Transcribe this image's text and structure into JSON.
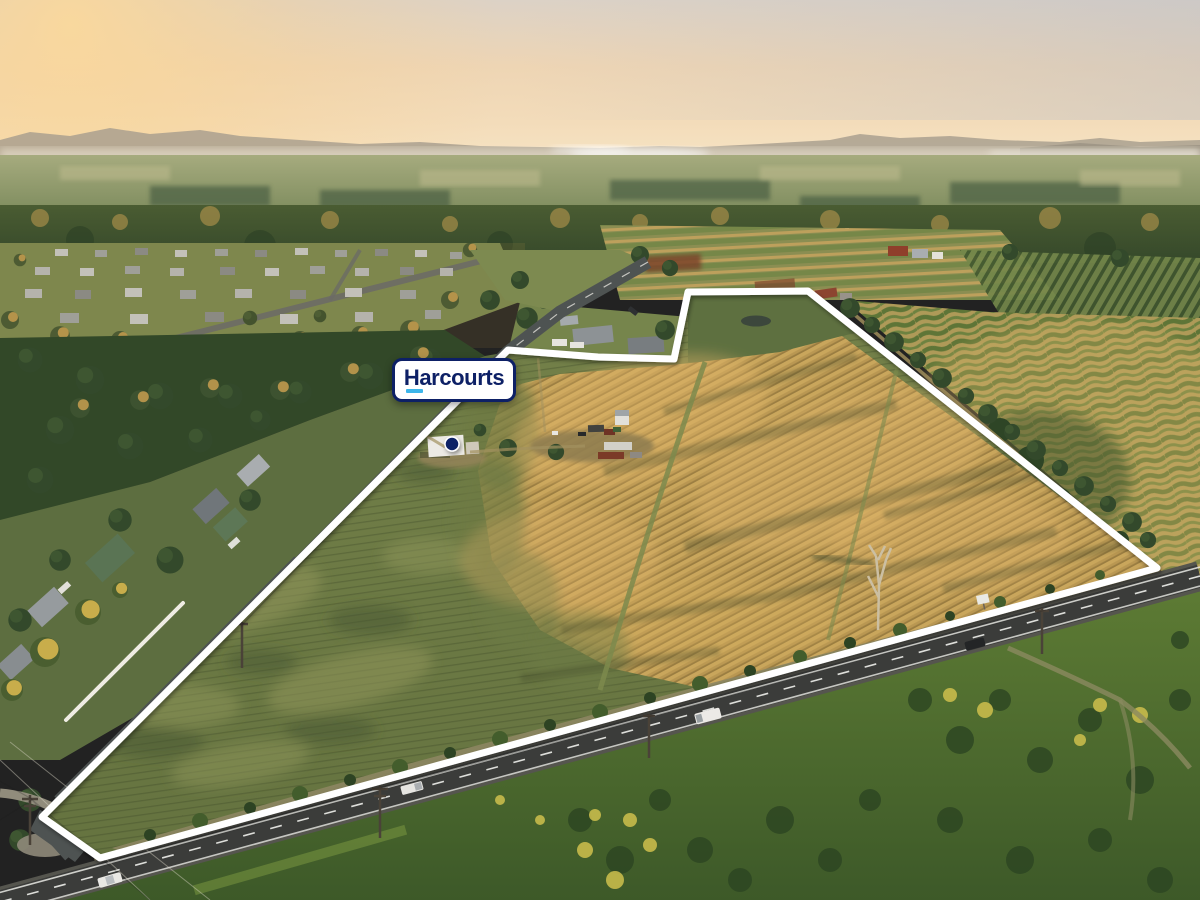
{
  "sign": {
    "label": "Harcourts"
  },
  "colors": {
    "brand_navy": "#0d2066",
    "brand_cyan": "#3db6ea",
    "boundary_white": "#ffffff"
  },
  "boundary": {
    "points": "42,817 508,350 598,357 674,359 688,292 808,291 1157,568 100,858"
  },
  "marker": {
    "dot_x": "452",
    "dot_y": "444",
    "dot_r": "7"
  }
}
